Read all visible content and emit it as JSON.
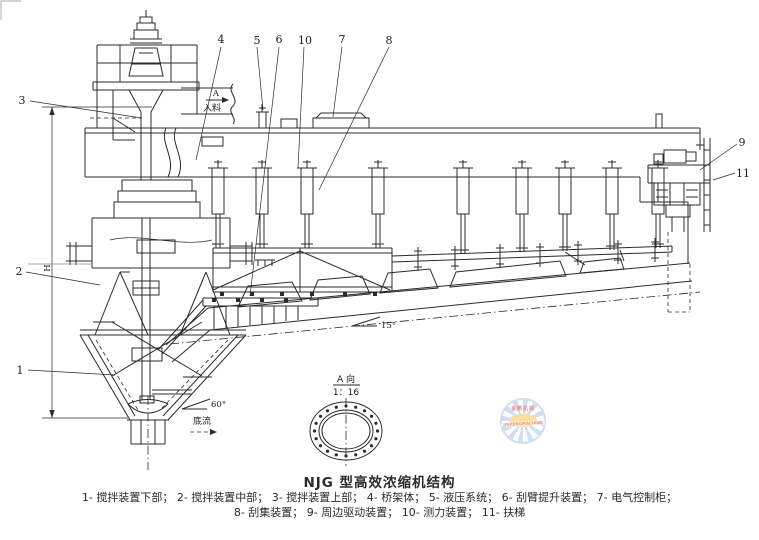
{
  "drawing": {
    "title": "NJG 型高效浓缩机结构",
    "legend": {
      "line1": "1- 搅拌装置下部；  2- 搅拌装置中部；  3- 搅拌装置上部；  4- 桥架体；  5- 液压系统；  6- 刮臂提升装置；  7- 电气控制柜；",
      "line2": "8- 刮集装置；  9- 周边驱动装置；  10- 测力装置；  11- 扶梯"
    },
    "callouts": {
      "c1": "1",
      "c2": "2",
      "c3": "3",
      "c4": "4",
      "c5": "5",
      "c6": "6",
      "c7": "7",
      "c8": "8",
      "c9": "9",
      "c10": "10",
      "c11": "11"
    },
    "annotations": {
      "view_arrow_letter": "A",
      "feed_label": "入料",
      "slope_angle": "15°",
      "cone_angle": "60°",
      "underflow_label": "底流",
      "height_dim_label": "H",
      "detail_view_label": "A 向",
      "detail_view_scale": "1：16"
    },
    "watermark": {
      "top_text": "金鹏机械",
      "banner_text": "JINPENGMACHINE"
    },
    "colors": {
      "ink": "#2b2b2b",
      "paper": "#ffffff",
      "watermark_blue": "#a8c4e6",
      "watermark_yellow": "#f5c64a",
      "watermark_red": "#d93a2f"
    }
  }
}
